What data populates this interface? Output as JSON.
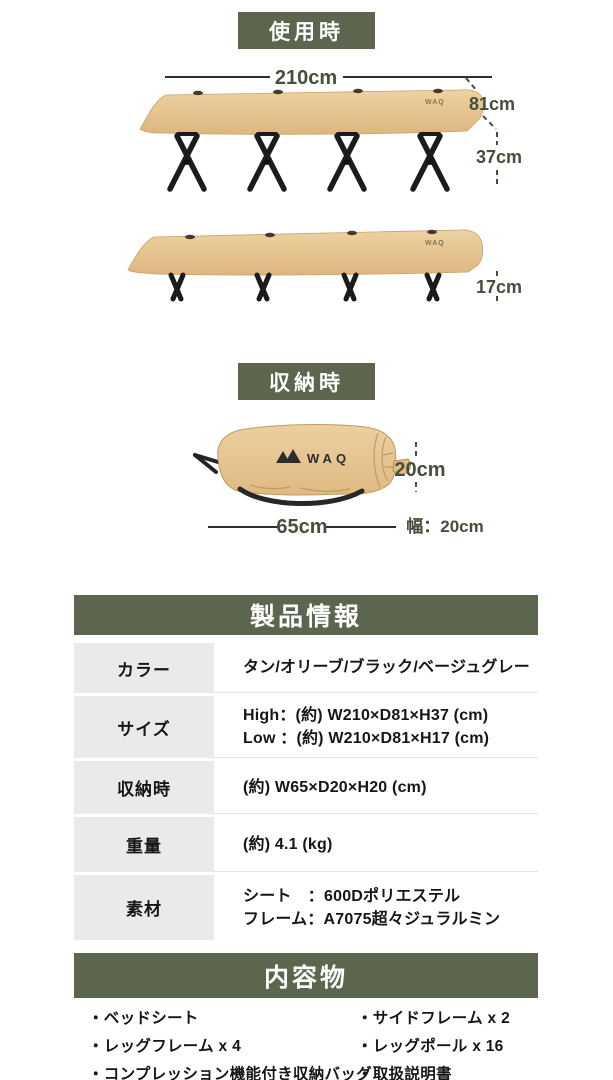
{
  "colors": {
    "olive_header": "#5c664e",
    "label_cell_gray": "#eaeaea",
    "fabric_tan": "#e7c795",
    "dimension_text": "#454f3b",
    "body_text": "#161616"
  },
  "sections": {
    "in_use_badge": "使用時",
    "storage_badge": "収納時"
  },
  "cot_high_diagram": {
    "width_label": "210cm",
    "depth_label": "81cm",
    "height_label": "37cm",
    "fabric_brand": "WAQ"
  },
  "cot_low_diagram": {
    "height_label": "17cm",
    "fabric_brand": "WAQ"
  },
  "bag_diagram": {
    "logo": "WAQ",
    "height_label": "20cm",
    "length_label": "65cm",
    "width_label": "幅：20cm"
  },
  "product_info": {
    "title": "製品情報",
    "rows": [
      {
        "label": "カラー",
        "lines": [
          "タン/オリーブ/ブラック/ベージュグレー"
        ]
      },
      {
        "label": "サイズ",
        "lines": [
          "High：(約) W210×D81×H37 (cm)",
          "Low ：(約) W210×D81×H17 (cm)"
        ]
      },
      {
        "label": "収納時",
        "lines": [
          "(約) W65×D20×H20 (cm)"
        ]
      },
      {
        "label": "重量",
        "lines": [
          "(約) 4.1 (kg)"
        ]
      },
      {
        "label": "素材",
        "lines": [
          "シート　：600Dポリエステル",
          "フレーム：A7075超々ジュラルミン"
        ]
      }
    ]
  },
  "contents": {
    "title": "内容物",
    "left_items": [
      "・ベッドシート",
      "・レッグフレーム x 4",
      "・コンプレッション機能付き収納バッグ"
    ],
    "right_items": [
      "・サイドフレーム x 2",
      "・レッグポール x 16",
      "・取扱説明書"
    ]
  }
}
